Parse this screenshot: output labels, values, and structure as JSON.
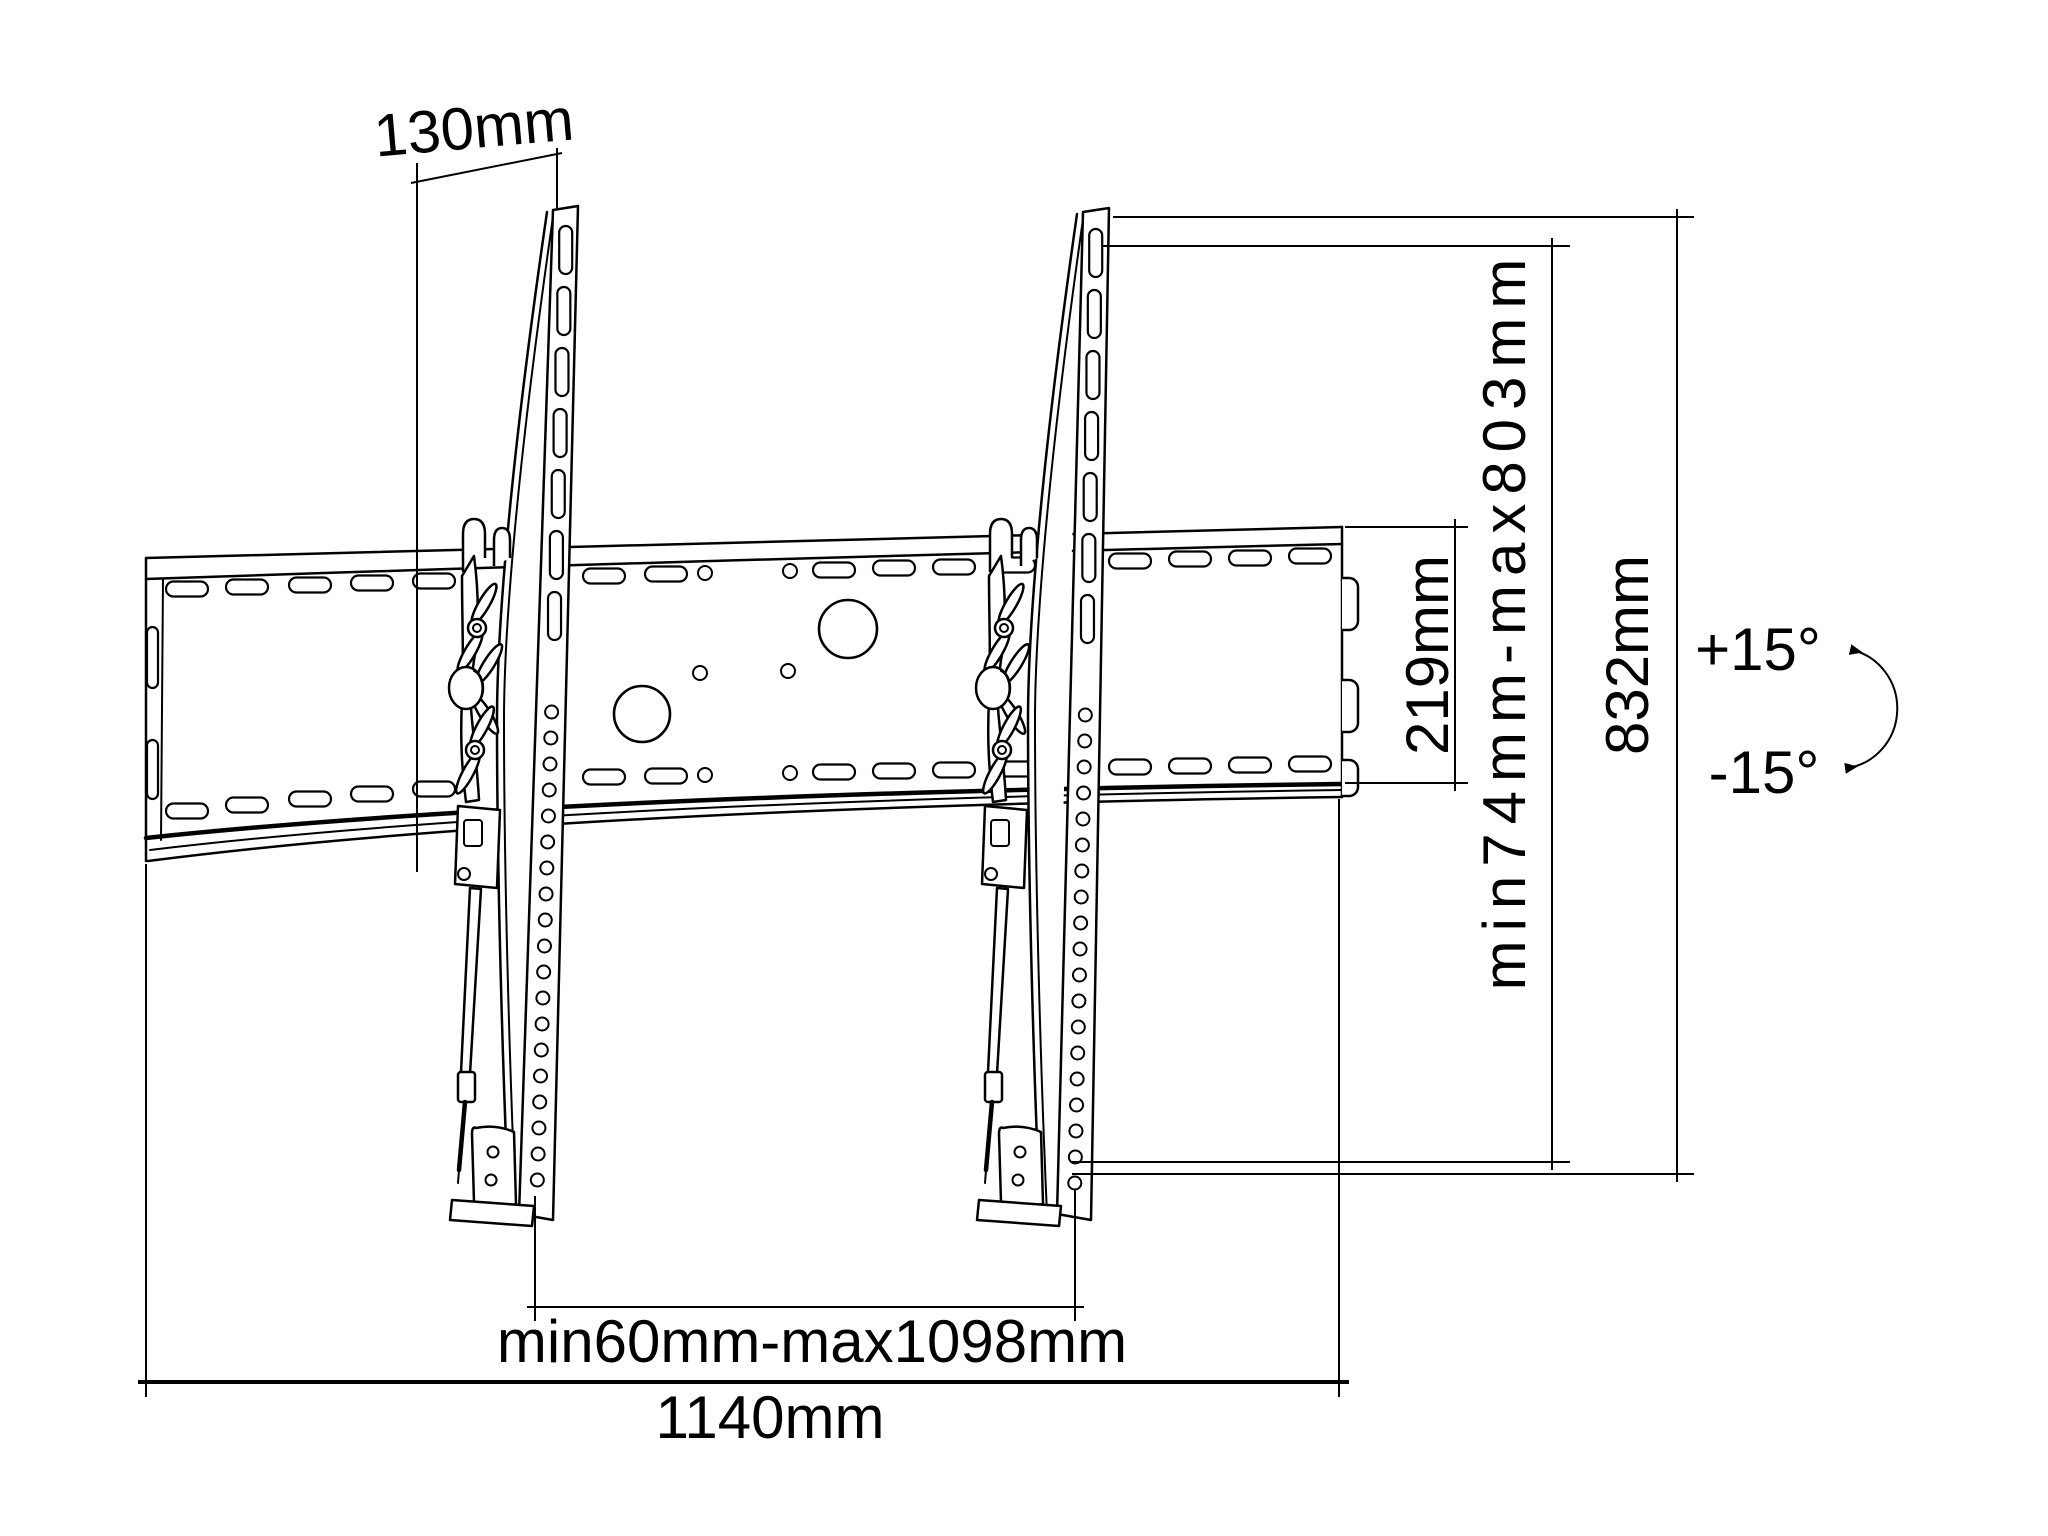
{
  "page": {
    "background": "#ffffff",
    "line_color": "#000000"
  },
  "diagram_type": "tv-wall-mount-dimension-drawing",
  "labels": {
    "depth_top": "130mm",
    "plate_height": "219mm",
    "vertical_range": "min74mm-max803mm",
    "bracket_height": "832mm",
    "tilt_up": "+15°",
    "tilt_down": "-15°",
    "rail_spacing": "min60mm-max1098mm",
    "plate_width": "1140mm"
  }
}
